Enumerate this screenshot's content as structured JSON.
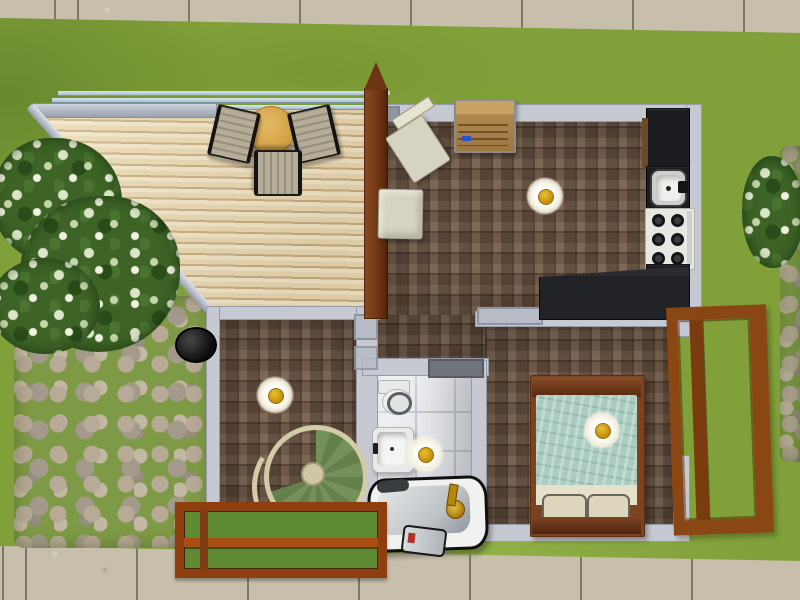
{
  "scene": {
    "description": "Top-down life-sim game screenshot of a small house lot",
    "view": "overhead floor plan with walls up",
    "rooms": [
      {
        "name": "living-kitchen",
        "floor": "brown parquet",
        "items": [
          "bookshelf",
          "dining chair",
          "side table",
          "ceiling lamp",
          "kitchen counter",
          "kitchen sink",
          "stove",
          "L-shaped counter"
        ]
      },
      {
        "name": "stair-room",
        "floor": "brown parquet",
        "items": [
          "ceiling lamp",
          "spiral staircase"
        ]
      },
      {
        "name": "bathroom",
        "floor": "white tile",
        "items": [
          "toilet",
          "pedestal sink",
          "ceiling lamp",
          "clawfoot bathtub"
        ]
      },
      {
        "name": "bedroom",
        "floor": "brown parquet",
        "items": [
          "double bed",
          "ceiling lamp",
          "open wooden door"
        ]
      }
    ],
    "outdoor_items": [
      "wooden deck",
      "patio table",
      "3 patio chairs",
      "deck railing",
      "flowering bushes",
      "cobblestone path",
      "barbecue pot",
      "wooden garden planter",
      "toppled trash can",
      "concrete sidewalks"
    ]
  },
  "labels": {
    "grass": "lawn grass",
    "sidewalk_top": "concrete sidewalk (north)",
    "sidewalk_bottom": "concrete sidewalk (south)",
    "stone_path": "cobblestone path",
    "stone_strip": "cobblestone path (east edge)",
    "deck": "wooden deck",
    "deck_railing": "deck railing",
    "deck_table": "round patio table",
    "deck_chair_west": "patio chair",
    "deck_chair_east": "patio chair",
    "deck_chair_south": "patio chair",
    "bush_large": "flowering bush",
    "bush_lower": "flowering bush",
    "bush_east": "flowering bush",
    "grill": "barbecue pot",
    "planter": "wooden garden planter",
    "trash_can": "toppled trash can",
    "living_room": "living room and kitchen",
    "hall": "hallway",
    "stair_room": "stair room",
    "bedroom": "bedroom",
    "bathroom": "bathroom",
    "bookshelf": "bookshelf",
    "cream_chair": "dining chair",
    "cream_table": "side table",
    "ceiling_lamp": "ceiling lamp",
    "counter": "kitchen counter",
    "kitchen_sink": "kitchen sink",
    "stove": "stove with six burners",
    "counter_l": "L-shaped kitchen counter",
    "toilet": "toilet",
    "pedestal_sink": "pedestal sink",
    "bathtub": "clawfoot bathtub",
    "bed": "double bed with teal blanket",
    "open_door": "open wooden door",
    "spiral_stairs": "spiral staircase",
    "wall": "wall",
    "window_sill": "window",
    "spine_wall": "wood-paneled gable wall"
  },
  "palette": {
    "grass": "#81a039",
    "sidewalk": "#c7beab",
    "deck_wood": "#ead8b0",
    "parquet": "#6b5443",
    "bath_tile": "#ebedf0",
    "wall": "#c6c9d1",
    "spine_wall_wood": "#6e3514",
    "counter_black": "#1c1d20",
    "door_wood": "#8a4714",
    "bed_blanket": "#abccc0",
    "stair_steps": "#75915b",
    "planter_wood": "#8f3f0f",
    "patio_table_top": "#d9a850",
    "lamp_gold": "#d8a51a",
    "railing_blue": "#bcd2da"
  }
}
